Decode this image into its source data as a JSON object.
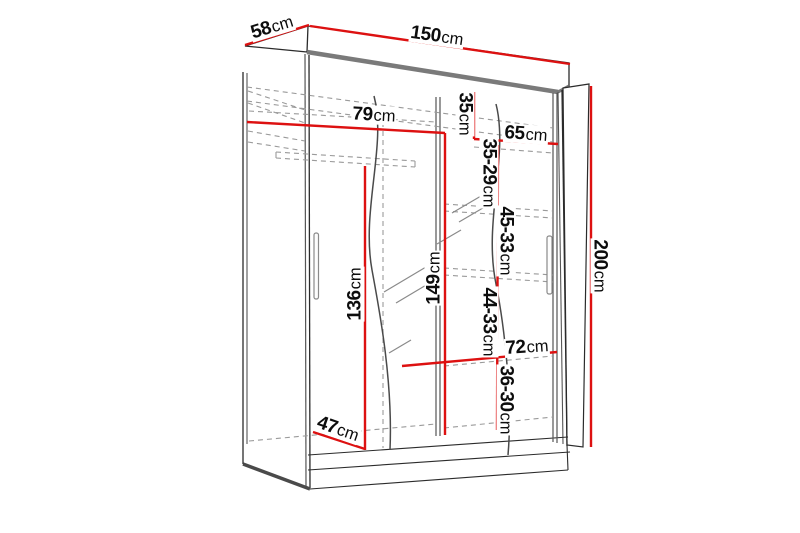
{
  "diagram_type": "wardrobe-dimension-diagram",
  "unit": "cm",
  "colors": {
    "dimension_line": "#dd1111",
    "outline": "#2b2b2b",
    "secondary_line": "#555555",
    "dashed_line": "#9a9a9a",
    "text": "#0d0d0d"
  },
  "labels": {
    "d58": {
      "num": "58",
      "unit": "cm"
    },
    "d150": {
      "num": "150",
      "unit": "cm"
    },
    "d200": {
      "num": "200",
      "unit": "cm"
    },
    "d79": {
      "num": "79",
      "unit": "cm"
    },
    "d35": {
      "num": "35",
      "unit": "cm"
    },
    "d65": {
      "num": "65",
      "unit": "cm"
    },
    "d3529": {
      "num": "35-29",
      "unit": "cm"
    },
    "d4533": {
      "num": "45-33",
      "unit": "cm"
    },
    "d149": {
      "num": "149",
      "unit": "cm"
    },
    "d136": {
      "num": "136",
      "unit": "cm"
    },
    "d4433": {
      "num": "44-33",
      "unit": "cm"
    },
    "d72": {
      "num": "72",
      "unit": "cm"
    },
    "d3630": {
      "num": "36-30",
      "unit": "cm"
    },
    "d47": {
      "num": "47",
      "unit": "cm"
    }
  }
}
